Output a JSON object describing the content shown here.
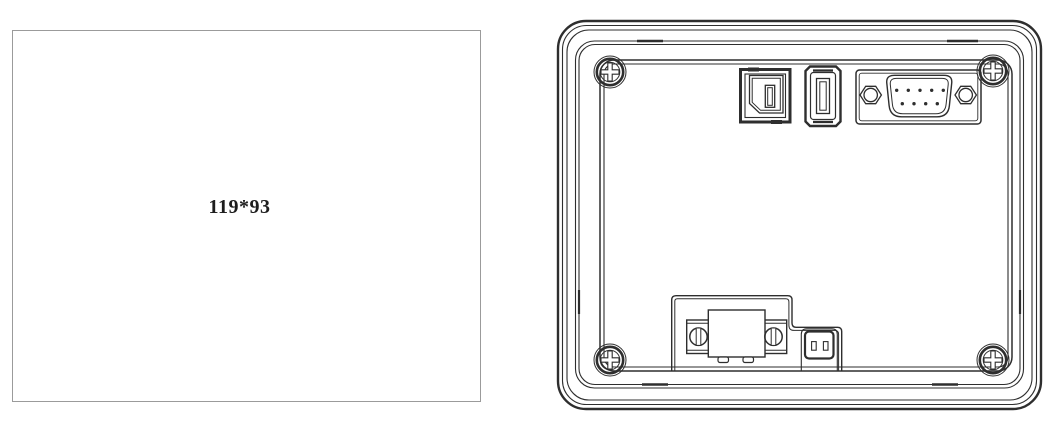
{
  "colors": {
    "line_dark": "#2e2e2e",
    "cutout_border": "#9b9b9b",
    "label_text": "#1d1d1d",
    "background": "#ffffff"
  },
  "cutout_view": {
    "dimensions_label": "119*93"
  },
  "rear_view": {
    "corner_screw_count": 4,
    "db9_pin_count": 9,
    "components": [
      "usb-b-port",
      "usb-a-port",
      "db9-serial-port",
      "terminal-block",
      "power-connector"
    ]
  }
}
